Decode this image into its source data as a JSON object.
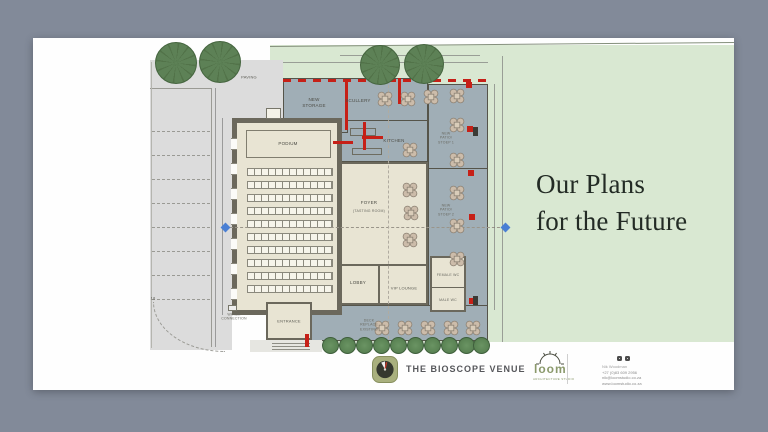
{
  "title": {
    "line1": "Our Plans",
    "line2": "for the Future"
  },
  "plan": {
    "rooms": {
      "podium": "PODIUM",
      "new_storage": "NEW\nSTORAGE",
      "scullery": "SCULLERY",
      "kitchen": "KITCHEN",
      "foyer": "FOYER",
      "foyer_sub": "(TASTING ROOM)",
      "new_patio_1": "NEW\nPATIO/\nSTOEP 1",
      "new_patio_2": "NEW\nPATIO/\nSTOEP 2",
      "lobby": "LOBBY",
      "vip_lounge": "VIP LOUNGE",
      "female_wc": "FEMALE WC",
      "male_wc": "MALE WC",
      "entrance": "ENTRANCE",
      "deck": "DECK\nREPLACE\nEXISTING",
      "paving": "PAVING",
      "water": "WATER\nCONNECTION",
      "parking_number": "18"
    }
  },
  "footer": {
    "venue_name": "THE BIOSCOPE VENUE",
    "studio_name": "loom",
    "studio_tagline": "ARCHITECTURE STUDIO",
    "contact_name": "Nik Woodman",
    "contact_phone": "+27 (0)83 609 2956",
    "contact_email": "nik@loomstudio.co.za",
    "contact_web": "www.loomstudio.co.za"
  },
  "colors": {
    "frame": "#828a99",
    "lawn": "#d9e8d2",
    "plan_gray": "#a0aeb6",
    "building_beige": "#e8e4d3",
    "wall": "#6b685c",
    "new_work_red": "#c62017",
    "tree_green": "#5d8156",
    "accent_green": "#8a996b"
  }
}
